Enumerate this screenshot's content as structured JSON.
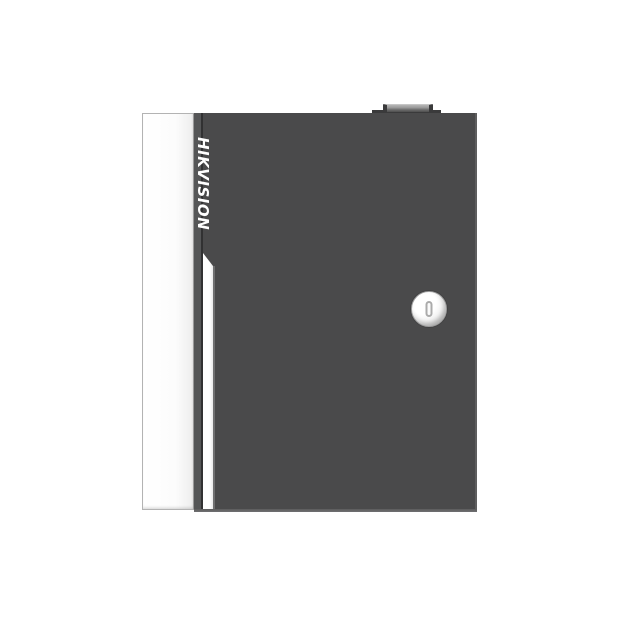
{
  "scene": {
    "type": "product-photograph",
    "subject": "wall-mount metal enclosure (access controller cabinet), front view, door closed",
    "background": "plain white"
  },
  "device": {
    "brand_label": "HIKVISION",
    "parts": {
      "side_panel": "white left side panel of cabinet",
      "door_panel": "dark charcoal front door",
      "door_stripe": "white vertical groove stripe with slanted top on left side of door",
      "cam_lock": "round silver cam lock, right-center of door",
      "keyhole": "vertical key slot in lock center",
      "hinge_knuckle": "small fitting protruding from top edge"
    }
  },
  "colors": {
    "background": "#ffffff",
    "door": "#4a4a4b",
    "door_edge": "#555657",
    "seam": "#313132",
    "stripe": "#fdfdfd",
    "side_panel_border": "#b3b3b3",
    "edge_highlight": "#5e5e5f",
    "lock_face": "#f2f2f2",
    "lock_rim": "#9c9c9c",
    "keyhole": "#ababab",
    "hinge_top": "#9d9d9d",
    "hinge_dark": "#3a3a3b",
    "logo_text": "#ffffff"
  }
}
